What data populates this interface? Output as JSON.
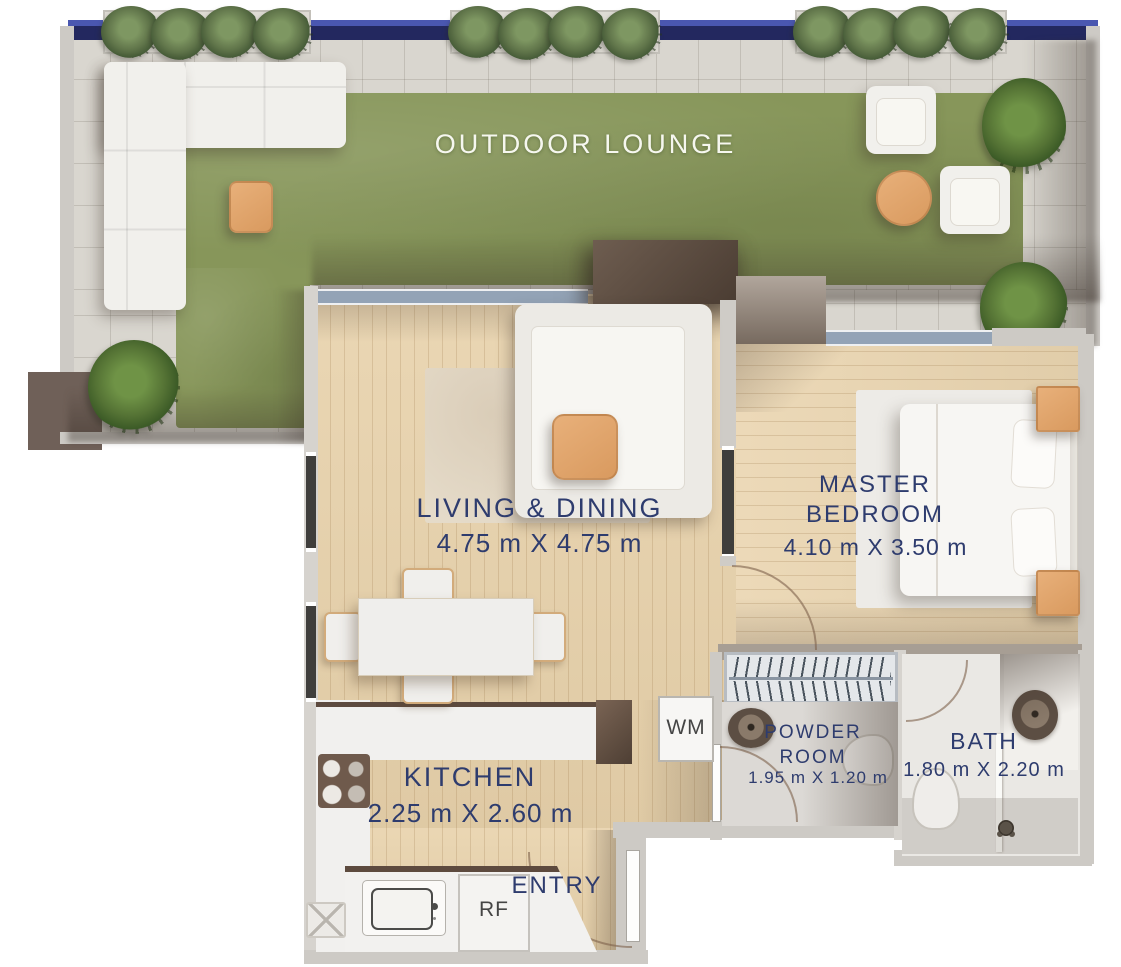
{
  "plan": {
    "outdoor": {
      "label": "OUTDOOR LOUNGE"
    },
    "living": {
      "label": "LIVING & DINING",
      "dims": "4.75 m X 4.75 m"
    },
    "master": {
      "label": "MASTER BEDROOM",
      "dims": "4.10 m X 3.50 m"
    },
    "kitchen": {
      "label": "KITCHEN",
      "dims": "2.25 m X 2.60 m"
    },
    "powder": {
      "label": "POWDER ROOM",
      "dims": "1.95 m X 1.20 m"
    },
    "bath": {
      "label": "BATH",
      "dims": "1.80 m X 2.20 m"
    },
    "entry": {
      "label": "ENTRY"
    },
    "appliances": {
      "washing_machine": "WM",
      "refrigerator": "RF"
    }
  },
  "colors": {
    "label_navy": "#2e3c6e",
    "railing_navy": "#2a2f72",
    "grass_green": "#87965a",
    "paver_gray": "#d9d6cf",
    "wood_tan": "#e8d2ab",
    "furniture_tan": "#e0a672",
    "wall_dark": "#55463c",
    "wall_gray": "#cdcac5"
  }
}
